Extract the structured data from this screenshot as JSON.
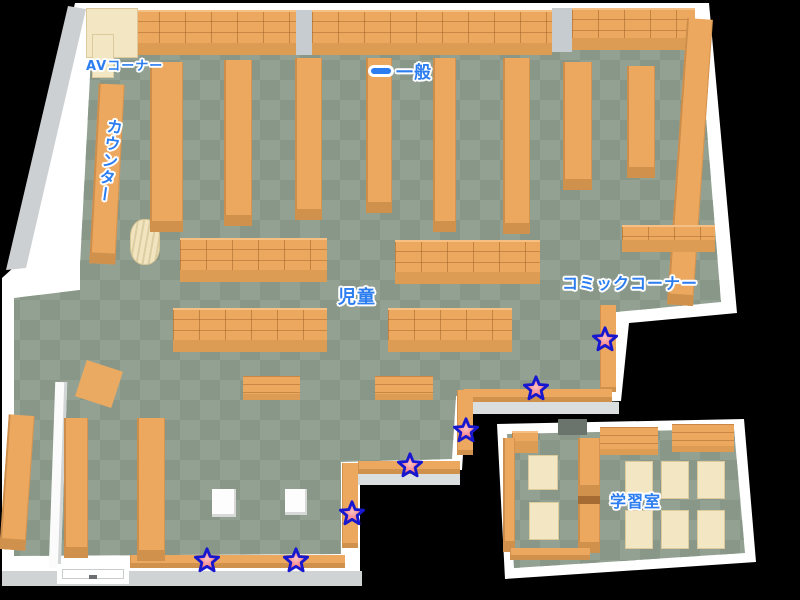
{
  "map": {
    "description": "library-floor-map",
    "labels": {
      "av_corner": {
        "text": "AVコーナー"
      },
      "counter": {
        "text": "カウンター"
      },
      "general": {
        "text": "一般"
      },
      "children": {
        "text": "児童"
      },
      "comic_corner": {
        "text": "コミックコーナー"
      },
      "study_room": {
        "text": "学習室"
      }
    },
    "markers": {
      "type": "star",
      "count": 7,
      "positions": [
        {
          "x": 605,
          "y": 339
        },
        {
          "x": 536,
          "y": 388
        },
        {
          "x": 466,
          "y": 430
        },
        {
          "x": 410,
          "y": 465
        },
        {
          "x": 352,
          "y": 513
        },
        {
          "x": 296,
          "y": 560
        },
        {
          "x": 207,
          "y": 560
        }
      ]
    },
    "colors": {
      "floor_light": "#93a193",
      "floor_dark": "#889788",
      "shelf_orange": "#eca85f",
      "shelf_front": "#d0914c",
      "desk_cream": "#f3e7c3",
      "wall_white": "#ffffff",
      "wall_gray": "#cdd0d2",
      "label_blue": "#2b7df0",
      "star_fill": "#f4767c",
      "star_outline": "#1717cf",
      "background": "#000000"
    }
  }
}
